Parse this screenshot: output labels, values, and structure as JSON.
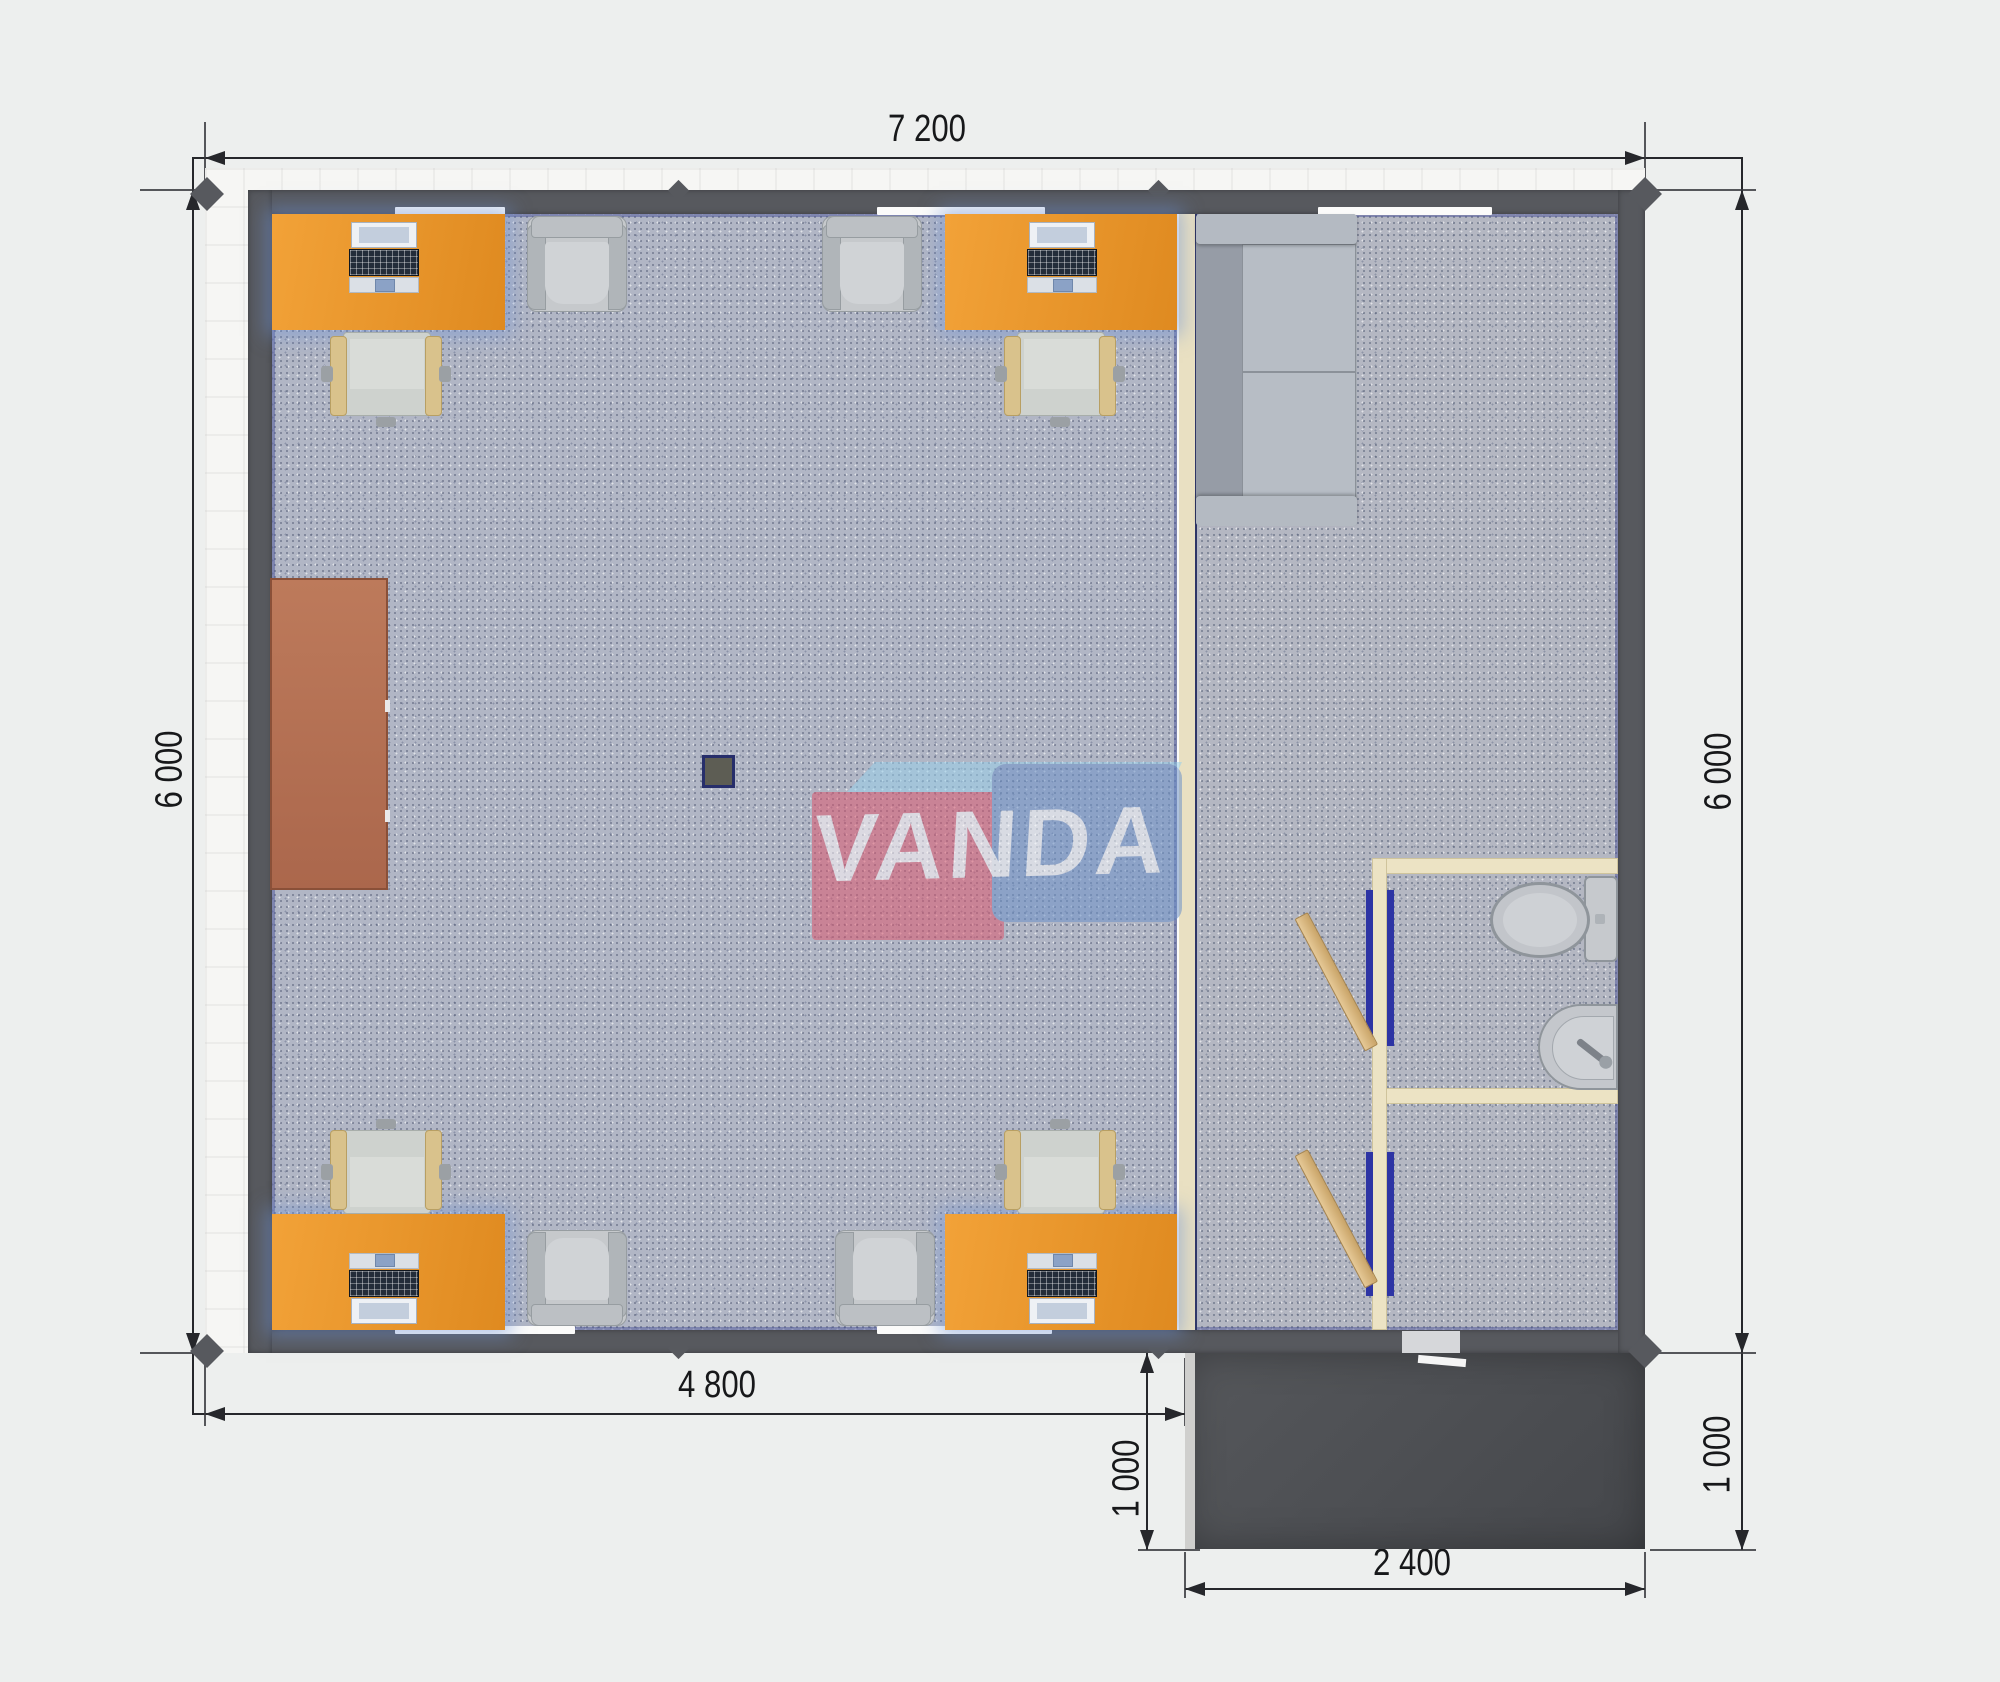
{
  "watermark": {
    "text": "VANDA"
  },
  "dimensions": {
    "width_total": "7 200",
    "height_left": "6 000",
    "height_right": "6 000",
    "width_office": "4 800",
    "porch_depth_left": "1 000",
    "porch_width": "2 400",
    "porch_depth_right": "1 000"
  },
  "plan": {
    "type": "modular-office-floor-plan-top-view",
    "rooms": [
      "open-office",
      "lounge-room",
      "wc-room",
      "hall-room",
      "entrance-porch"
    ],
    "furniture": [
      {
        "name": "office-desk-with-laptop",
        "count": 4,
        "color": "#e8922d"
      },
      {
        "name": "desk-chair",
        "count": 4
      },
      {
        "name": "armchair",
        "count": 4
      },
      {
        "name": "sofa",
        "count": 1
      },
      {
        "name": "cabinet",
        "count": 1,
        "color": "#b5755a"
      },
      {
        "name": "toilet",
        "count": 1
      },
      {
        "name": "sink",
        "count": 1
      },
      {
        "name": "interior-door",
        "count": 2
      },
      {
        "name": "structural-column",
        "count": 1
      }
    ],
    "colors": {
      "wall": "#57595e",
      "floor_office": "#b1b6c5",
      "floor_room": "#b4b7c2",
      "desk": "#e8922d",
      "partition": "#e9e0c2",
      "porch": "#4d4f53",
      "dimension_text": "#17181a",
      "door_frame_blue": "#2d34a4",
      "door_leaf": "#d9b77f",
      "logo_red": "#dd5a70",
      "logo_blue": "#6e93c9",
      "logo_light_blue": "#9ad0ea"
    }
  }
}
